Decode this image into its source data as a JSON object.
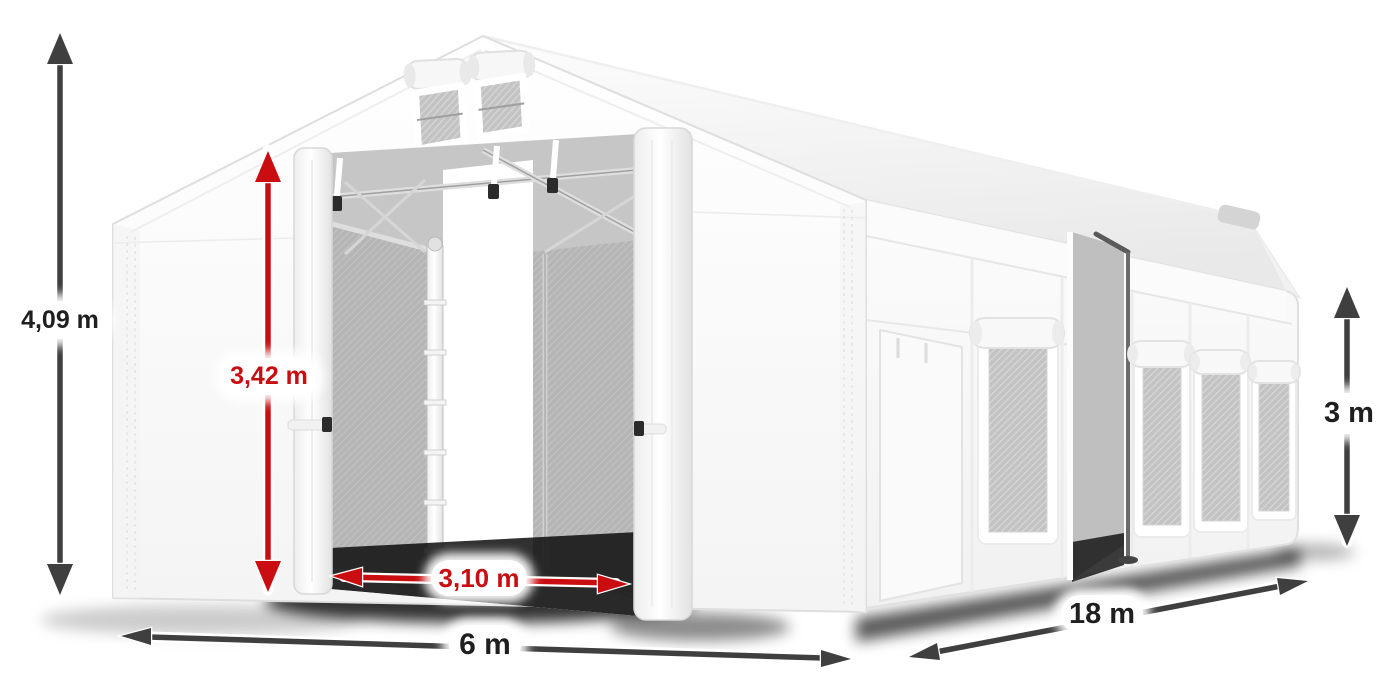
{
  "dimensions": {
    "total_height": "4,09 m",
    "door_height": "3,42 m",
    "door_width": "3,10 m",
    "front_width": "6 m",
    "side_length": "18 m",
    "side_height": "3 m"
  },
  "colors": {
    "red": "#c90d10",
    "gray": "#3f3f3f",
    "ink": "#1f1f1f"
  }
}
